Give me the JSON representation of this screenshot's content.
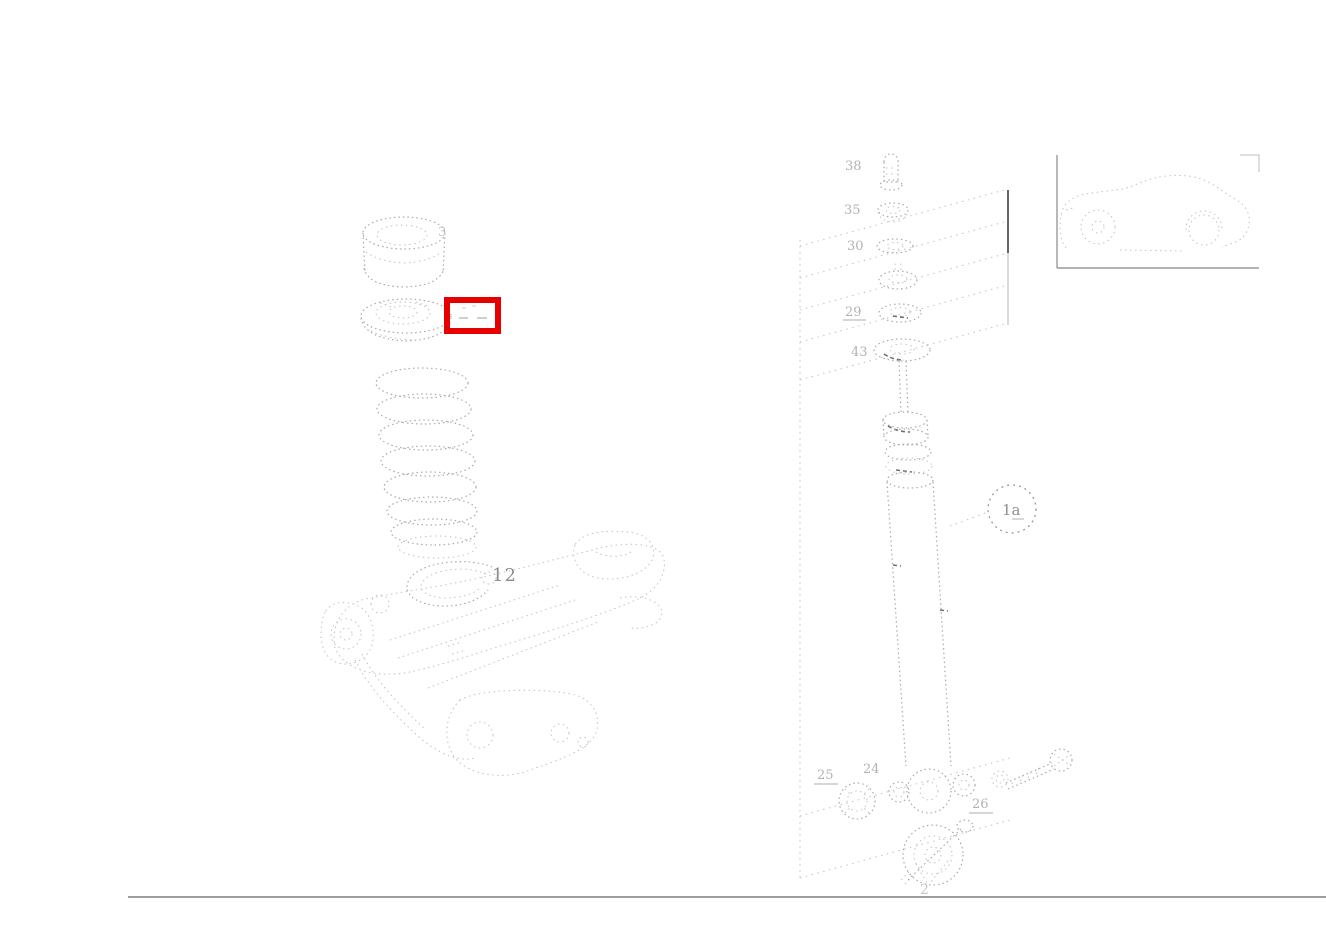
{
  "page": {
    "background": "#ffffff",
    "type": "parts-catalog-exploded-diagram",
    "description": "Rear suspension exploded drawing: coil spring, bump stop and axle carrier on the left; shock absorber with mounting hardware on the right; car silhouette inset top-right; red box highlighting the spring-seat callout."
  },
  "colors": {
    "highlight_red": "#e60000",
    "sketch_gray": "#aaaaaa",
    "faint_label_gray": "#b3b3b3",
    "rule_gray": "#9c9c9c"
  },
  "diagram": {
    "callouts": {
      "bump_stop": "3",
      "spring_clip": "12",
      "shock_absorber": "1a",
      "top_stack": [
        "38",
        "35",
        "30",
        "29",
        "43"
      ],
      "lower_washer": "25",
      "lower_bushing": "24",
      "lower_nut": "26",
      "bottom_mount": "2"
    },
    "highlight_box": {
      "x": 447,
      "y": 300,
      "width": 51,
      "height": 31
    }
  }
}
